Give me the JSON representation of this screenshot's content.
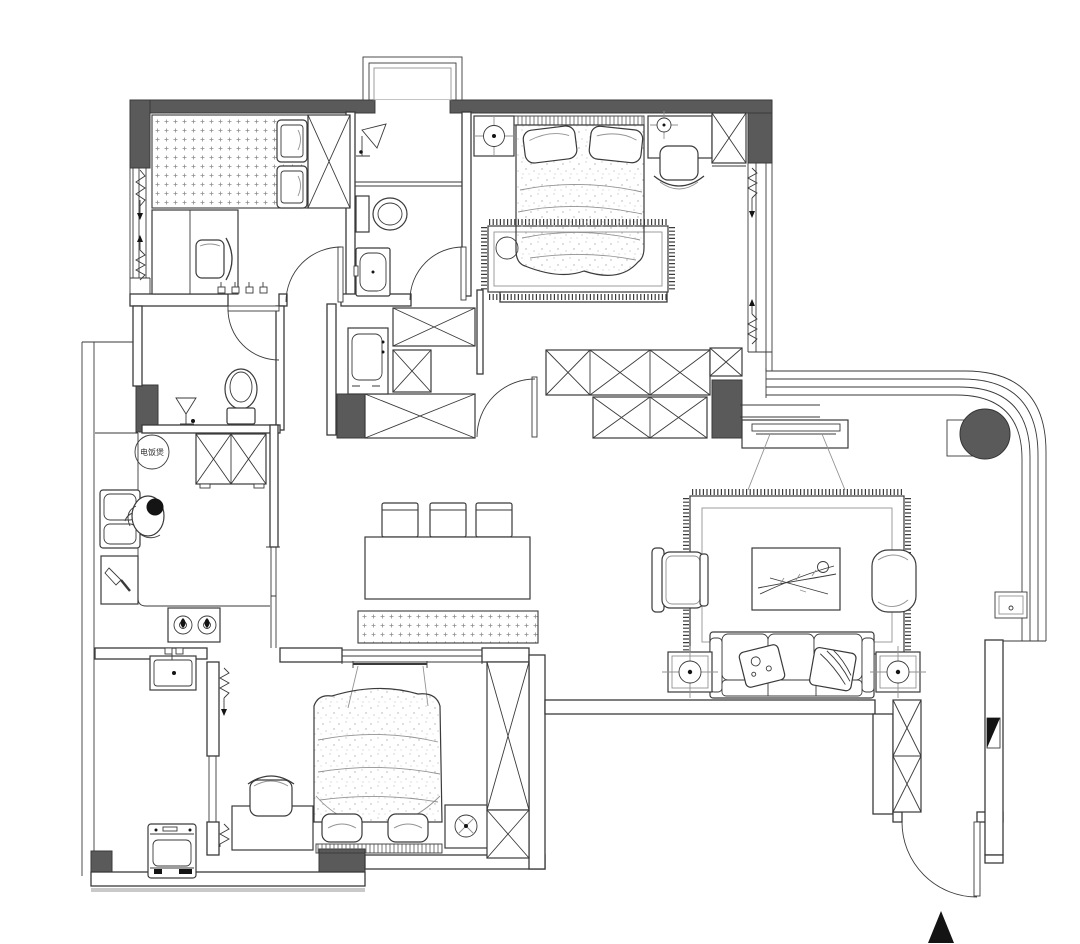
{
  "page": {
    "title": "Apartment floor plan drawing",
    "canvas_width": 1080,
    "canvas_height": 944,
    "background": "#ffffff"
  },
  "colors": {
    "wall-fill": "#5a5a5a",
    "line": "#3a3a3a",
    "light-line": "#929292",
    "accent-black": "#141414",
    "floor-gray": "#c9c9c9"
  },
  "labels": {
    "kitchen_rice_cooker": "电饭煲"
  },
  "markers": {
    "north_arrow": "filled-triangle-up",
    "entry_section_marker": "half-filled-triangle"
  },
  "rooms": [
    {
      "name": "bedroom-2-tatami",
      "items": [
        "tatami-platform-bed",
        "two-pillows",
        "x-wardrobe",
        "desk",
        "chair",
        "window-with-curtain"
      ]
    },
    {
      "name": "bathroom",
      "items": [
        "shower-symbol",
        "toilet",
        "wash-basin",
        "swing-door"
      ]
    },
    {
      "name": "master-bedroom",
      "items": [
        "double-bed",
        "two-pillows",
        "nightstand-lamp",
        "vanity-desk",
        "chair",
        "area-rug",
        "floor-cushion",
        "x-wardrobe",
        "window-with-curtain"
      ]
    },
    {
      "name": "wc",
      "items": [
        "toilet",
        "floor-drain-symbol",
        "swing-door"
      ]
    },
    {
      "name": "kitchen",
      "items": [
        "refrigerator-x",
        "double-sink",
        "person-figure",
        "cutting-board-knife",
        "two-burner-stove",
        "rice-cooker-label",
        "sliding-door"
      ]
    },
    {
      "name": "hallway",
      "items": [
        "x-closets",
        "washer-cabinet",
        "swing-door",
        "dark-columns"
      ]
    },
    {
      "name": "dining",
      "items": [
        "dining-table",
        "three-chairs",
        "dotted-bench",
        "interior-window"
      ]
    },
    {
      "name": "living-room",
      "items": [
        "tv-panel",
        "tv-cabinet",
        "area-rug",
        "coffee-table-decor",
        "armchair",
        "pouf",
        "three-seat-sofa",
        "two-throw-pillows",
        "side-table-lamps"
      ]
    },
    {
      "name": "bedroom-3",
      "items": [
        "double-bed",
        "two-pillows",
        "desk",
        "chair",
        "nightstand-lamp",
        "x-wardrobe",
        "curtain"
      ]
    },
    {
      "name": "laundry-balcony",
      "items": [
        "sink",
        "washing-machine",
        "sliding-door"
      ]
    },
    {
      "name": "entry",
      "items": [
        "entry-swing-door",
        "shoe-cabinet-x",
        "section-marker"
      ]
    },
    {
      "name": "curved-balcony",
      "items": [
        "curved-glass-wall",
        "round-column",
        "wall-panel"
      ]
    }
  ]
}
